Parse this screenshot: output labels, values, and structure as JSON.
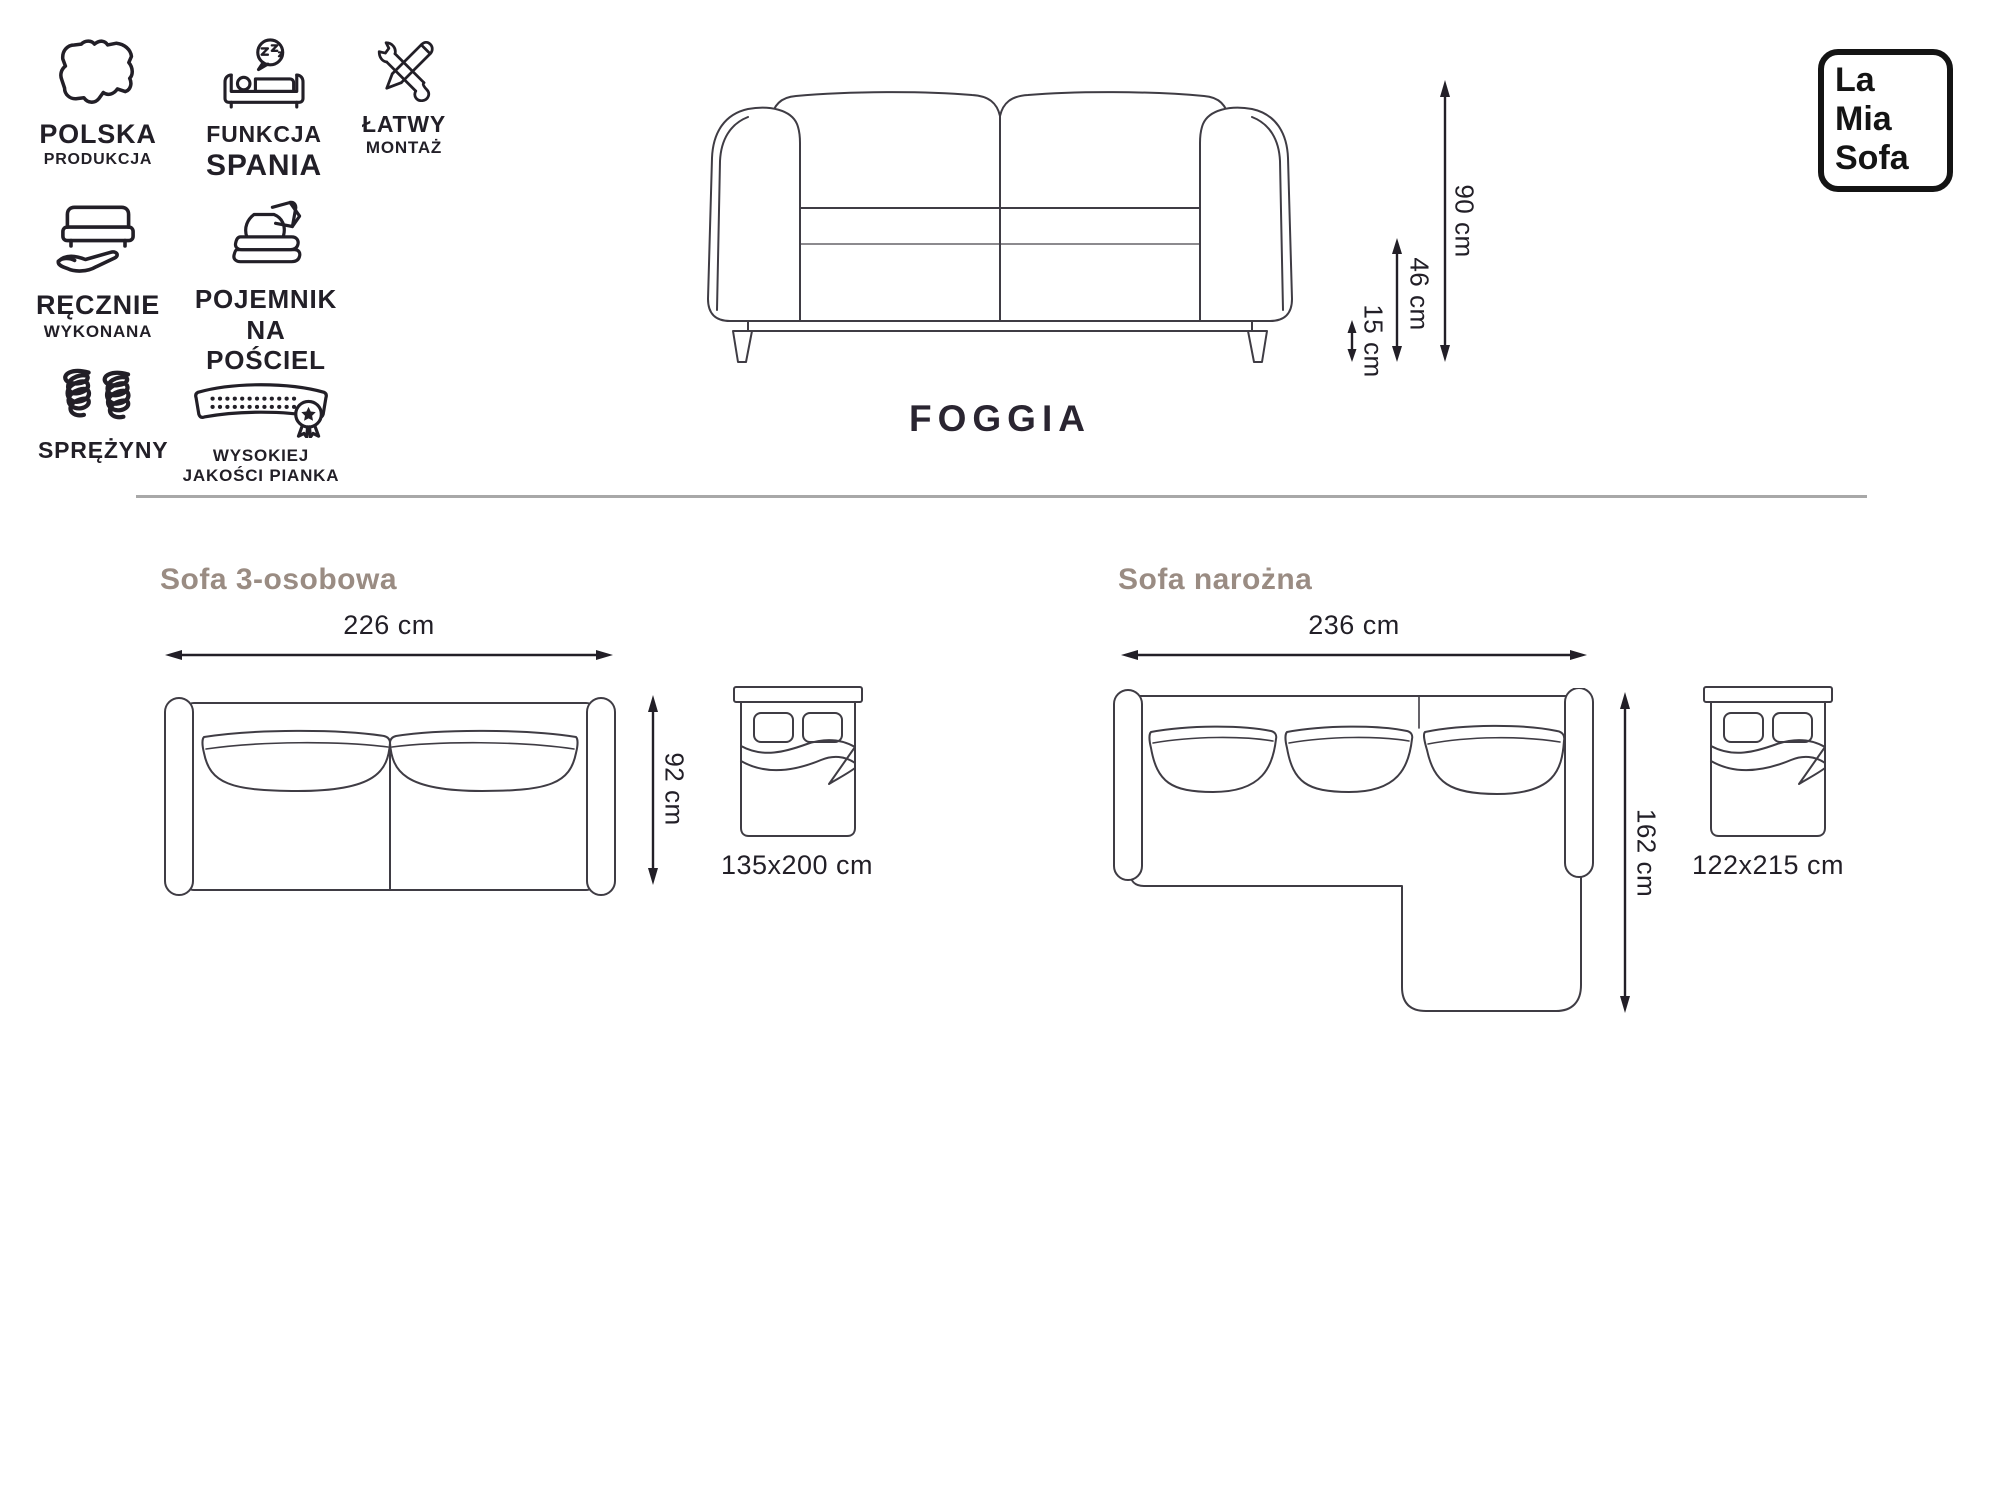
{
  "product": {
    "name": "FOGGIA"
  },
  "brand_logo": {
    "line1": "La",
    "line2": "Mia",
    "line3": "Sofa"
  },
  "features": [
    {
      "icon": "poland-map-icon",
      "line1": "POLSKA",
      "line2": "PRODUKCJA"
    },
    {
      "icon": "sleep-function-icon",
      "line1": "FUNKCJA",
      "line2": "SPANIA"
    },
    {
      "icon": "tools-icon",
      "line1": "ŁATWY",
      "line2": "MONTAŻ"
    },
    {
      "icon": "handmade-icon",
      "line1": "RĘCZNIE",
      "line2": "WYKONANA"
    },
    {
      "icon": "bedding-container-icon",
      "line1": "POJEMNIK",
      "line2": "NA POŚCIEL"
    },
    {
      "icon": "springs-icon",
      "line1": "SPRĘŻYNY",
      "line2": ""
    },
    {
      "icon": "foam-icon",
      "line1": "WYSOKIEJ",
      "line2": "JAKOŚCI PIANKA"
    }
  ],
  "front_view": {
    "total_height": "90 cm",
    "seat_height": "46 cm",
    "leg_height": "15 cm"
  },
  "sections": [
    {
      "title": "Sofa 3-osobowa",
      "width": "226 cm",
      "depth": "92 cm",
      "bed_size": "135x200 cm"
    },
    {
      "title": "Sofa narożna",
      "width": "236 cm",
      "depth": "162 cm",
      "bed_size": "122x215 cm"
    }
  ],
  "colors": {
    "ink": "#221f27",
    "line": "#3f3c44",
    "heading": "#9a8c83",
    "divider": "#a8a8a8"
  }
}
